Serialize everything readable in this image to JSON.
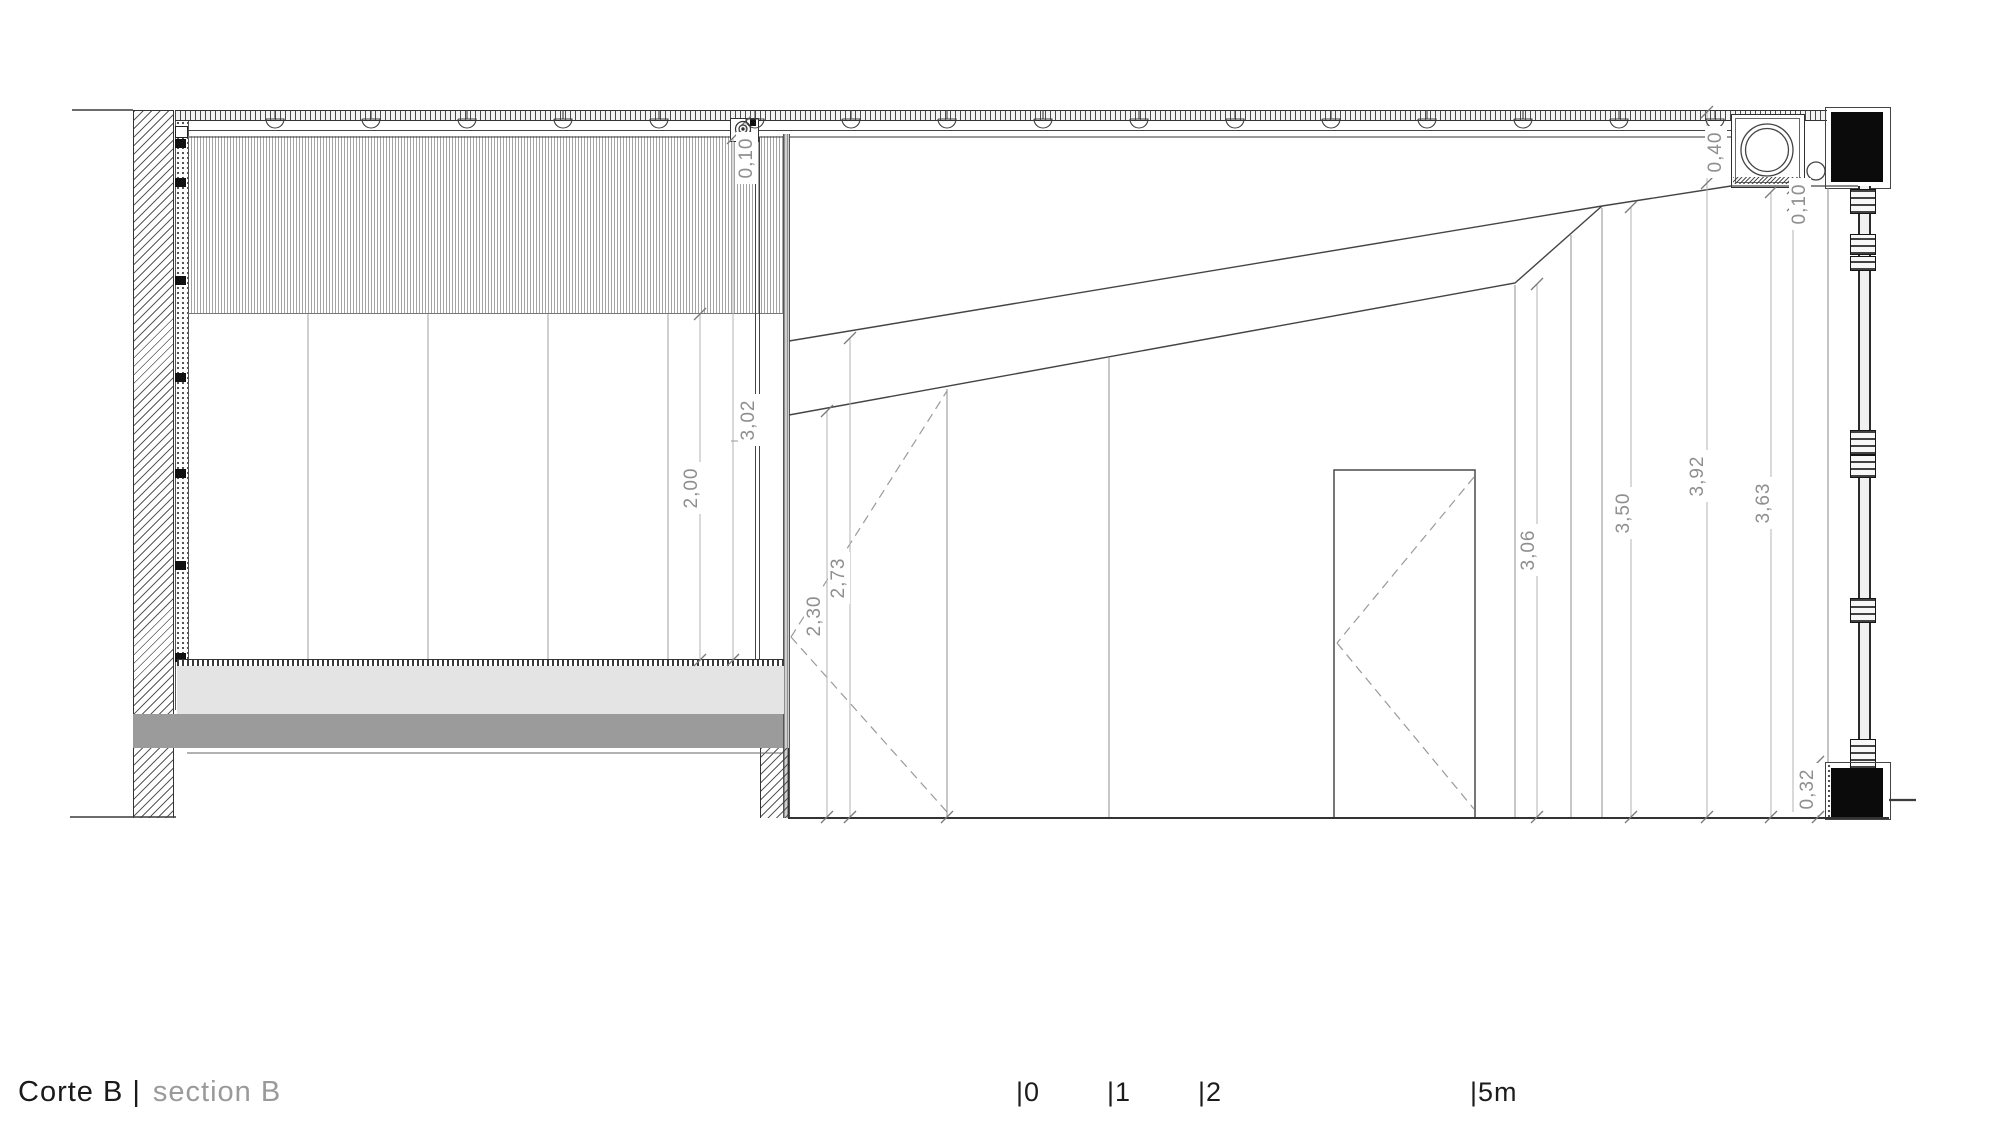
{
  "title": {
    "primary": "Corte B |",
    "secondary": "section B"
  },
  "scale_bar": {
    "ticks": [
      "|0",
      "|1",
      "|2",
      "|5m"
    ]
  },
  "dimensions": [
    {
      "name": "roof-slab-thickness-left",
      "value": "0,10"
    },
    {
      "name": "left-room-total-height",
      "value": "3,02"
    },
    {
      "name": "left-room-clear-height",
      "value": "2,00"
    },
    {
      "name": "right-room-height-at-partition",
      "value": "2,30"
    },
    {
      "name": "right-room-height-at-slope-top",
      "value": "2,73"
    },
    {
      "name": "right-room-height-mid",
      "value": "3,06"
    },
    {
      "name": "right-room-height-at-apex",
      "value": "3,50"
    },
    {
      "name": "right-room-height-to-roof",
      "value": "3,92"
    },
    {
      "name": "right-room-height-under-beam",
      "value": "3,63"
    },
    {
      "name": "roof-edge-beam-depth",
      "value": "0,40"
    },
    {
      "name": "roof-slab-thickness-right",
      "value": "0,10"
    },
    {
      "name": "floor-beam-height",
      "value": "0,32"
    }
  ],
  "colors": {
    "line": "#3c3c3c",
    "thin_line": "#9a9a9a",
    "dim_text": "#8f8f8f",
    "title_primary": "#1a1a1a",
    "title_secondary": "#9a9a9a",
    "slab_light": "#e4e4e4",
    "slab_dark": "#9b9b9b",
    "solid_fill": "#0b0b0b"
  }
}
